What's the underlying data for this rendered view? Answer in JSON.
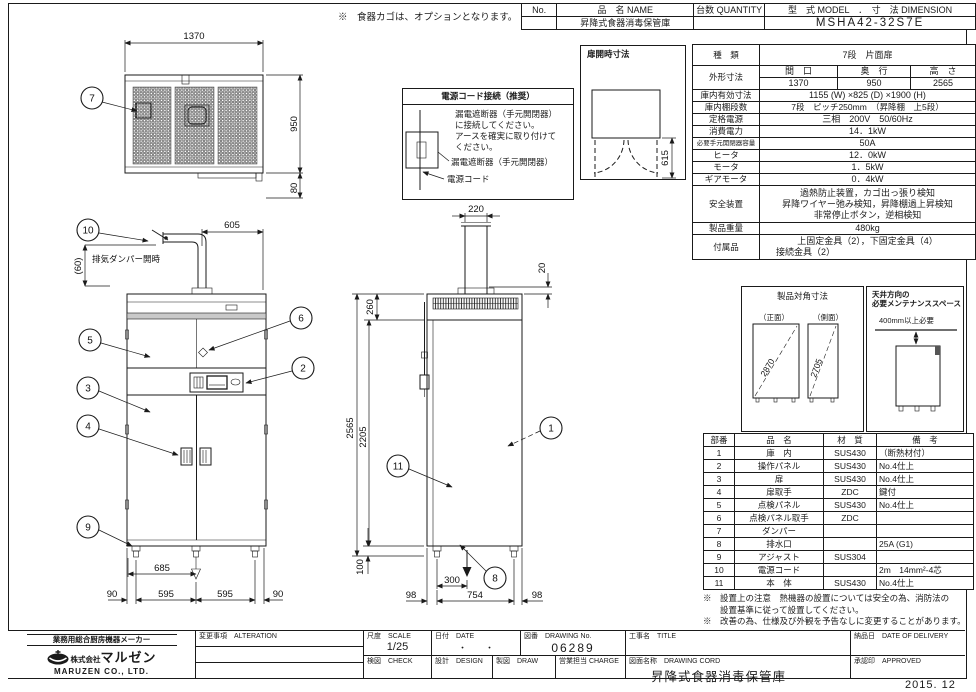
{
  "header_table": {
    "no_label": "No.",
    "name_label": "品　名 NAME",
    "qty_label": "台数 QUANTITY",
    "model_label": "型　式 MODEL　．　寸　法 DIMENSION",
    "name_value": "昇降式食器消毒保管庫",
    "model_value": "MSHA42-32S7E"
  },
  "top_note": "※　食器カゴは、オプションとなります。",
  "spec_table": {
    "kind_label": "種　類",
    "kind_value": "7段　片面扉",
    "outer_label": "外形寸法",
    "w_label": "間　口",
    "d_label": "奥　行",
    "h_label": "高　さ",
    "w_value": "1370",
    "d_value": "950",
    "h_value": "2565",
    "inner_label": "庫内有効寸法",
    "inner_value": "1155 (W) ×825 (D) ×1900 (H)",
    "shelf_label": "庫内棚段数",
    "shelf_value": "7段　ピッチ250mm　（昇降棚　上5段）",
    "power_label": "定格電源",
    "power_value": "三相　200V　50/60Hz",
    "consumption_label": "消費電力",
    "consumption_value": "14．1kW",
    "breaker_label": "必要手元開閉器容量",
    "breaker_value": "50A",
    "heater_label": "ヒータ",
    "heater_value": "12．0kW",
    "motor_label": "モータ",
    "motor_value": "1．5kW",
    "gear_label": "ギアモータ",
    "gear_value": "0．4kW",
    "safety_label": "安全装置",
    "safety_value1": "過熱防止装置，カゴ出っ張り検知",
    "safety_value2": "昇降ワイヤー弛み検知，昇降棚過上昇検知",
    "safety_value3": "非常停止ボタン，逆相検知",
    "weight_label": "製品重量",
    "weight_value": "480kg",
    "accessory_label": "付属品",
    "accessory_value1": "上固定金具（2），下固定金具（4）",
    "accessory_value2": "接続金具（2）"
  },
  "door_open_box": {
    "title": "扉開時寸法",
    "dim": "615"
  },
  "power_cord_box": {
    "title": "電源コード接続（推奨）",
    "line1": "漏電遮断器（手元開閉器）",
    "line2": "に接続してください。",
    "line3": "アースを確実に取り付けて",
    "line4": "ください。",
    "label1": "漏電遮断器（手元開閉器）",
    "label2": "電源コード"
  },
  "diagonal_box": {
    "title": "製品対角寸法",
    "front_label": "（正面）",
    "side_label": "（側面）",
    "front_value": "2870",
    "side_value": "2705"
  },
  "maintenance_box": {
    "title1": "天井方向の",
    "title2": "必要メンテナンススペース",
    "clearance": "400mm以上必要"
  },
  "parts_table": {
    "headers": [
      "部番",
      "品　名",
      "材　質",
      "備　考"
    ],
    "rows": [
      [
        "1",
        "庫　内",
        "SUS430",
        "（断熱材付）"
      ],
      [
        "2",
        "操作パネル",
        "SUS430",
        "No.4仕上"
      ],
      [
        "3",
        "扉",
        "SUS430",
        "No.4仕上"
      ],
      [
        "4",
        "扉取手",
        "ZDC",
        "鍵付"
      ],
      [
        "5",
        "点検パネル",
        "SUS430",
        "No.4仕上"
      ],
      [
        "6",
        "点検パネル取手",
        "ZDC",
        ""
      ],
      [
        "7",
        "ダンパー",
        "",
        ""
      ],
      [
        "8",
        "排水口",
        "",
        "25A (G1)"
      ],
      [
        "9",
        "アジャスト",
        "SUS304",
        ""
      ],
      [
        "10",
        "電源コード",
        "",
        "2m　14mm²-4芯"
      ],
      [
        "11",
        "本　体",
        "SUS430",
        "No.4仕上"
      ]
    ]
  },
  "notes": {
    "note1a": "※　設置上の注意　熱機器の設置については安全の為、消防法の",
    "note1b": "　　設置基準に従って設置してください。",
    "note2": "※　改善の為、仕様及び外観を予告なしに変更することがあります。"
  },
  "title_block": {
    "maker_tagline": "業務用総合厨房機器メーカー",
    "company_prefix": "株式会社",
    "company_name": "マルゼン",
    "company_en": "MARUZEN  CO., LTD.",
    "alteration_label": "変更事項　ALTERATION",
    "scale_label": "尺度　SCALE",
    "scale_value": "1/25",
    "date_label": "日付　DATE",
    "date_value": "・　　・",
    "drawing_no_label": "図番　DRAWING No.",
    "drawing_no_value": "06289",
    "title_label": "工事名　TITLE",
    "delivery_label": "納品日　DATE OF DELIVERY",
    "check_label": "検図　CHECK",
    "design_label": "設計　DESIGN",
    "draw_label": "製図　DRAW",
    "charge_label": "営業担当 CHARGE",
    "drawing_name_label": "図面名称　DRAWING CORD",
    "drawing_name_value": "昇降式食器消毒保管庫",
    "approved_label": "承認印　APPROVED",
    "date_bottom": "2015. 12"
  },
  "dims": {
    "plan_width": "1370",
    "plan_depth": "950",
    "plan_back": "80",
    "front_exhaust": "605",
    "front_exhaust_h": "(60)",
    "exhaust_note": "排気ダンパー開時",
    "front_drain": "685",
    "front_b1": "90",
    "front_b2": "595",
    "front_b3": "595",
    "front_b4": "90",
    "side_chimney": "220",
    "side_cap": "20",
    "side_top": "260",
    "side_h1": "2565",
    "side_h2": "2205",
    "side_leg": "100",
    "side_drain": "300",
    "side_b1": "98",
    "side_b2": "754",
    "side_b3": "98"
  },
  "balloons": {
    "b1": "1",
    "b2": "2",
    "b3": "3",
    "b4": "4",
    "b5": "5",
    "b6": "6",
    "b7": "7",
    "b8": "8",
    "b9": "9",
    "b10": "10",
    "b11": "11"
  }
}
